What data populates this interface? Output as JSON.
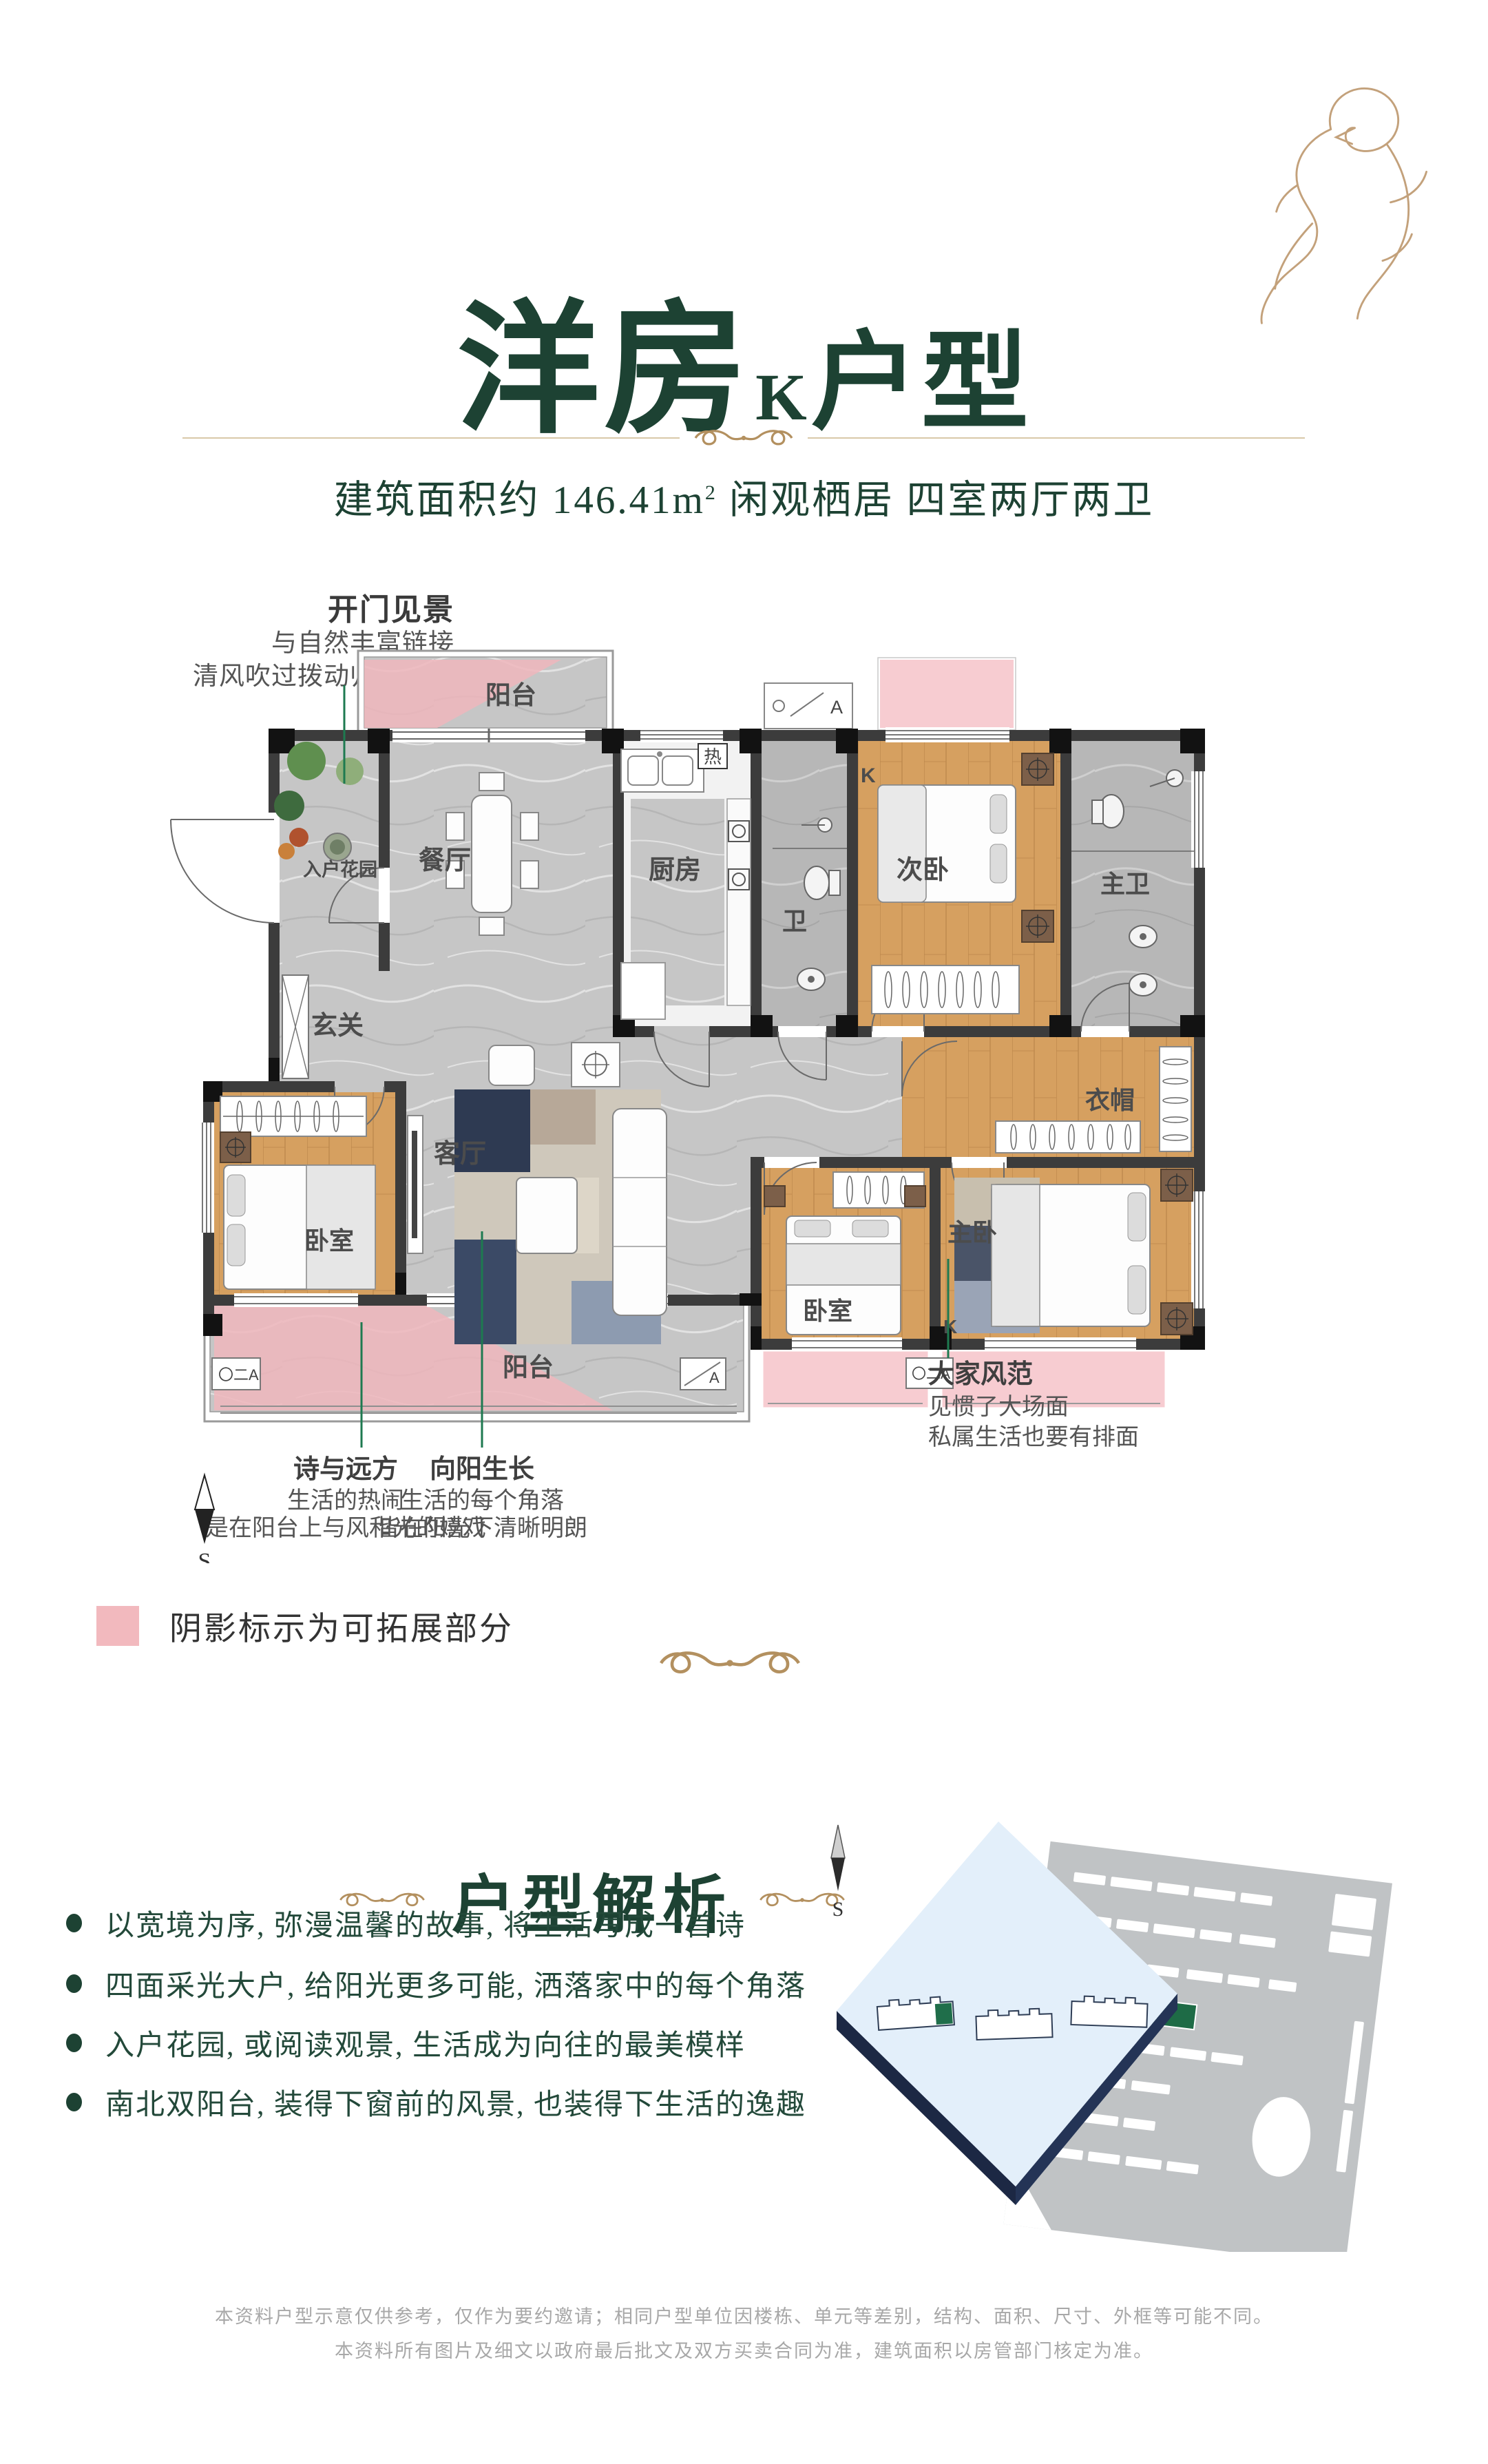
{
  "header": {
    "title_main": "洋房",
    "title_grade": "K",
    "title_suffix": "户型",
    "subtitle_prefix": "建筑面积约 146.41m",
    "subtitle_sup": "2",
    "subtitle_rest": " 闲观栖居  四室两厅两卫"
  },
  "floor_plan": {
    "rooms": {
      "north_balcony": "阳台",
      "entry_garden": "入户花园",
      "dining": "餐厅",
      "kitchen": "厨房",
      "bath": "卫",
      "second_bedroom": "次卧",
      "master_bath": "主卫",
      "foyer": "玄关",
      "cloakroom": "衣帽",
      "living": "客厅",
      "bedroom_west": "卧室",
      "bedroom_mid": "卧室",
      "master_bedroom": "主卧",
      "south_balcony": "阳台"
    },
    "tags": {
      "k": "K",
      "heater": "热",
      "window_a": "A",
      "window_code": "〇二A"
    }
  },
  "annotations": {
    "open_view": {
      "title": "开门见景",
      "line1": "与自然丰富链接",
      "line2": "清风吹过拨动归人心弦"
    },
    "poetry": {
      "title": "诗与远方",
      "line1": "生活的热闹",
      "line2": "是在阳台上与风和光的嬉戏"
    },
    "sunny": {
      "title": "向阳生长",
      "line1": "生活的每个角落",
      "line2": "皆在阳光下清晰明朗"
    },
    "grand": {
      "title": "大家风范",
      "line1": "见惯了大场面",
      "line2": "私属生活也要有排面"
    }
  },
  "legend": {
    "text": "阴影标示为可拓展部分",
    "color": "#f2b9be"
  },
  "compass": {
    "south": "S"
  },
  "analysis": {
    "title": "户型解析",
    "bullets": [
      "以宽境为序, 弥漫温馨的故事, 将生活写成一首诗",
      "四面采光大户, 给阳光更多可能, 洒落家中的每个角落",
      "入户花园, 或阅读观景, 生活成为向往的最美模样",
      "南北双阳台, 装得下窗前的风景, 也装得下生活的逸趣"
    ]
  },
  "footer": {
    "line1": "本资料户型示意仅供参考，仅作为要约邀请；相同户型单位因楼栋、单元等差别，结构、面积、尺寸、外框等可能不同。",
    "line2": "本资料所有图片及细文以政府最后批文及双方买卖合同为准，建筑面积以房管部门核定为准。"
  },
  "colors": {
    "brand_green": "#1d4233",
    "accent_gold": "#b3905f",
    "expand_pink": "#f2c6ca",
    "annotation_green": "#1e7a50"
  }
}
